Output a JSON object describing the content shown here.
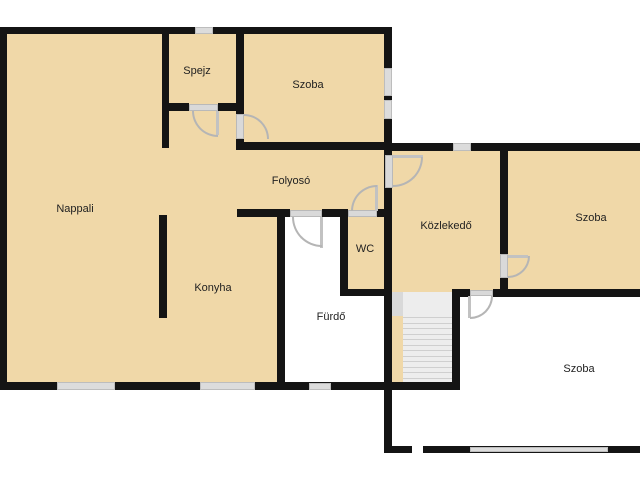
{
  "plan": {
    "colors": {
      "bg": "#ffffff",
      "floor": "#f0d8a8",
      "wall": "#141414",
      "window": "#dcdcdc",
      "door_frame": "#d9d9d9",
      "door_leaf": "#c2c2c2",
      "door_arc": "#b5b5b5",
      "stair_well": "#ededed",
      "stair_block": "#d9d9d9",
      "tread": "#cfcfcf",
      "label": "#222222"
    },
    "rooms": [
      {
        "id": "nappali",
        "label": "Nappali",
        "x": 75,
        "y": 209
      },
      {
        "id": "spejz",
        "label": "Spejz",
        "x": 197,
        "y": 71
      },
      {
        "id": "szoba-top-left",
        "label": "Szoba",
        "x": 308,
        "y": 85
      },
      {
        "id": "folyoso",
        "label": "Folyosó",
        "x": 291,
        "y": 181
      },
      {
        "id": "konyha",
        "label": "Konyha",
        "x": 213,
        "y": 288
      },
      {
        "id": "wc",
        "label": "WC",
        "x": 365,
        "y": 249
      },
      {
        "id": "furdo",
        "label": "Fürdő",
        "x": 331,
        "y": 317
      },
      {
        "id": "kozlekedo",
        "label": "Közlekedő",
        "x": 446,
        "y": 226
      },
      {
        "id": "szoba-top-right",
        "label": "Szoba",
        "x": 591,
        "y": 218
      },
      {
        "id": "szoba-bottom",
        "label": "Szoba",
        "x": 579,
        "y": 369
      }
    ],
    "floors": [
      {
        "x": 7,
        "y": 34,
        "w": 378,
        "h": 348,
        "fill": "floor"
      },
      {
        "x": 283,
        "y": 217,
        "w": 57,
        "h": 165,
        "fill": "bg"
      },
      {
        "x": 340,
        "y": 296,
        "w": 45,
        "h": 86,
        "fill": "bg"
      },
      {
        "x": 392,
        "y": 151,
        "w": 248,
        "h": 141,
        "fill": "floor"
      },
      {
        "x": 392,
        "y": 316,
        "w": 11,
        "h": 67,
        "fill": "floor"
      }
    ],
    "walls": [
      {
        "x": 0,
        "y": 27,
        "w": 392,
        "h": 7
      },
      {
        "x": 0,
        "y": 27,
        "w": 7,
        "h": 363
      },
      {
        "x": 0,
        "y": 382,
        "w": 460,
        "h": 8
      },
      {
        "x": 384,
        "y": 27,
        "w": 8,
        "h": 426
      },
      {
        "x": 162,
        "y": 34,
        "w": 7,
        "h": 114
      },
      {
        "x": 236,
        "y": 34,
        "w": 8,
        "h": 109
      },
      {
        "x": 162,
        "y": 103,
        "w": 27,
        "h": 8
      },
      {
        "x": 218,
        "y": 103,
        "w": 18,
        "h": 8
      },
      {
        "x": 236,
        "y": 142,
        "w": 156,
        "h": 8
      },
      {
        "x": 159,
        "y": 215,
        "w": 8,
        "h": 103
      },
      {
        "x": 237,
        "y": 209,
        "w": 53,
        "h": 8
      },
      {
        "x": 322,
        "y": 209,
        "w": 26,
        "h": 8
      },
      {
        "x": 377,
        "y": 209,
        "w": 13,
        "h": 8
      },
      {
        "x": 277,
        "y": 217,
        "w": 8,
        "h": 168
      },
      {
        "x": 340,
        "y": 217,
        "w": 8,
        "h": 75
      },
      {
        "x": 340,
        "y": 289,
        "w": 52,
        "h": 7
      },
      {
        "x": 452,
        "y": 289,
        "w": 8,
        "h": 101
      },
      {
        "x": 392,
        "y": 143,
        "w": 61,
        "h": 8
      },
      {
        "x": 471,
        "y": 143,
        "w": 169,
        "h": 8
      },
      {
        "x": 500,
        "y": 151,
        "w": 8,
        "h": 103
      },
      {
        "x": 500,
        "y": 278,
        "w": 8,
        "h": 18
      },
      {
        "x": 452,
        "y": 289,
        "w": 18,
        "h": 8
      },
      {
        "x": 493,
        "y": 289,
        "w": 147,
        "h": 8
      },
      {
        "x": 385,
        "y": 446,
        "w": 27,
        "h": 7
      },
      {
        "x": 423,
        "y": 446,
        "w": 217,
        "h": 7
      }
    ],
    "windows": [
      {
        "x": 195,
        "y": 27,
        "w": 18,
        "h": 7
      },
      {
        "x": 384,
        "y": 68,
        "w": 8,
        "h": 28
      },
      {
        "x": 384,
        "y": 100,
        "w": 8,
        "h": 19
      },
      {
        "x": 453,
        "y": 143,
        "w": 18,
        "h": 8
      },
      {
        "x": 57,
        "y": 382,
        "w": 58,
        "h": 8
      },
      {
        "x": 200,
        "y": 382,
        "w": 55,
        "h": 8
      },
      {
        "x": 309,
        "y": 383,
        "w": 22,
        "h": 7
      },
      {
        "x": 470,
        "y": 447,
        "w": 138,
        "h": 5
      }
    ],
    "door_frames": [
      {
        "x": 189,
        "y": 104,
        "w": 29,
        "h": 7
      },
      {
        "x": 236,
        "y": 114,
        "w": 8,
        "h": 25
      },
      {
        "x": 348,
        "y": 210,
        "w": 29,
        "h": 7
      },
      {
        "x": 290,
        "y": 210,
        "w": 32,
        "h": 7
      },
      {
        "x": 385,
        "y": 155,
        "w": 8,
        "h": 33
      },
      {
        "x": 500,
        "y": 254,
        "w": 8,
        "h": 24
      },
      {
        "x": 470,
        "y": 290,
        "w": 23,
        "h": 6
      }
    ],
    "door_leaves": [
      {
        "x": 216,
        "y": 111,
        "w": 3,
        "h": 24
      },
      {
        "x": 375,
        "y": 185,
        "w": 3,
        "h": 26
      },
      {
        "x": 320,
        "y": 217,
        "w": 3,
        "h": 31
      },
      {
        "x": 393,
        "y": 155,
        "w": 30,
        "h": 3
      },
      {
        "x": 508,
        "y": 255,
        "w": 20,
        "h": 3
      },
      {
        "x": 468,
        "y": 296,
        "w": 3,
        "h": 22
      }
    ],
    "door_arcs": [
      {
        "x": 192,
        "y": 111,
        "s": 26,
        "corner": "bl"
      },
      {
        "x": 244,
        "y": 114,
        "s": 25,
        "corner": "tr"
      },
      {
        "x": 351,
        "y": 185,
        "s": 26,
        "corner": "tl"
      },
      {
        "x": 292,
        "y": 217,
        "s": 30,
        "corner": "bl"
      },
      {
        "x": 393,
        "y": 157,
        "s": 30,
        "corner": "br"
      },
      {
        "x": 508,
        "y": 256,
        "s": 22,
        "corner": "br"
      },
      {
        "x": 470,
        "y": 296,
        "s": 23,
        "corner": "br"
      }
    ],
    "stairs": {
      "block": {
        "x": 392,
        "y": 292,
        "w": 11,
        "h": 24
      },
      "well": {
        "x": 403,
        "y": 292,
        "w": 49,
        "h": 91
      },
      "treads": {
        "x": 403,
        "w": 49,
        "y_start": 317,
        "y_end": 378,
        "count": 12
      }
    }
  }
}
